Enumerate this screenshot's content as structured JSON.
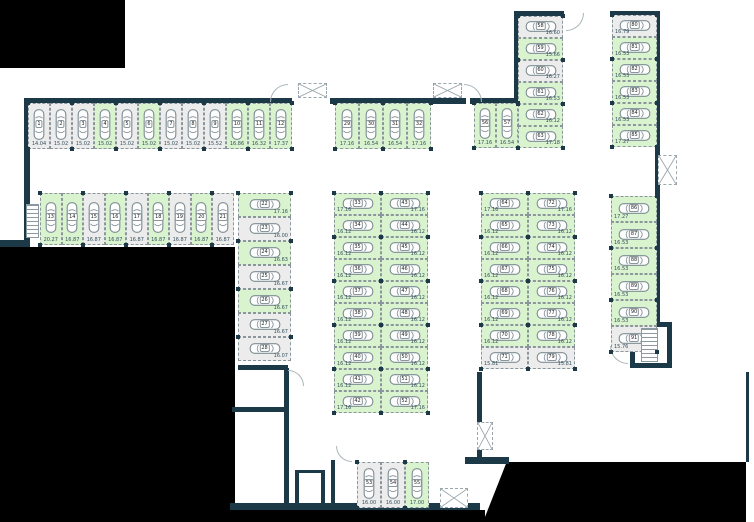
{
  "plan": {
    "name": "underground-parking-level-plan",
    "colors": {
      "wall": "#1c3947",
      "available_fill": "#d8f3cd",
      "occupied_fill": "#ececec",
      "void": "#000000"
    },
    "groups": [
      {
        "name": "north-row-west",
        "stack": "h",
        "x": 28,
        "y": 103,
        "w": 22,
        "h": 46,
        "label": "bottom",
        "stalls": [
          {
            "n": "1",
            "size": "14.04",
            "state": "occupied"
          },
          {
            "n": "2",
            "size": "15.02",
            "state": "occupied"
          },
          {
            "n": "3",
            "size": "15.02",
            "state": "occupied"
          },
          {
            "n": "4",
            "size": "15.02",
            "state": "available"
          },
          {
            "n": "5",
            "size": "15.02",
            "state": "occupied"
          },
          {
            "n": "6",
            "size": "15.02",
            "state": "available"
          },
          {
            "n": "7",
            "size": "15.02",
            "state": "occupied"
          },
          {
            "n": "8",
            "size": "15.02",
            "state": "occupied"
          },
          {
            "n": "9",
            "size": "15.52",
            "state": "occupied"
          },
          {
            "n": "10",
            "size": "16.86",
            "state": "available"
          },
          {
            "n": "11",
            "size": "16.32",
            "state": "available"
          },
          {
            "n": "12",
            "size": "17.37",
            "state": "available"
          }
        ]
      },
      {
        "name": "north-row-mid",
        "stack": "h",
        "x": 335,
        "y": 103,
        "w": 24,
        "h": 46,
        "label": "bottom",
        "stalls": [
          {
            "n": "29",
            "size": "17.16",
            "state": "available"
          },
          {
            "n": "30",
            "size": "16.54",
            "state": "available"
          },
          {
            "n": "31",
            "size": "16.54",
            "state": "available"
          },
          {
            "n": "32",
            "size": "17.16",
            "state": "available"
          }
        ]
      },
      {
        "name": "north-row-east",
        "stack": "h",
        "x": 474,
        "y": 103,
        "w": 22,
        "h": 45,
        "label": "bottom",
        "stalls": [
          {
            "n": "56",
            "size": "17.16",
            "state": "available"
          },
          {
            "n": "57",
            "size": "16.54",
            "state": "available"
          }
        ]
      },
      {
        "name": "northeast-col-west",
        "stack": "v",
        "x": 518,
        "y": 16,
        "w": 45,
        "h": 22,
        "label": "right",
        "stalls": [
          {
            "n": "58",
            "size": "16.60",
            "state": "occupied"
          },
          {
            "n": "59",
            "size": "15.66",
            "state": "available"
          },
          {
            "n": "60",
            "size": "16.27",
            "state": "occupied"
          },
          {
            "n": "61",
            "size": "16.53",
            "state": "available"
          },
          {
            "n": "62",
            "size": "16.12",
            "state": "available"
          },
          {
            "n": "63",
            "size": "17.18",
            "state": "available"
          }
        ]
      },
      {
        "name": "northeast-col-east",
        "stack": "v",
        "x": 612,
        "y": 15,
        "w": 45,
        "h": 22,
        "label": "left",
        "stalls": [
          {
            "n": "80",
            "size": "16.79",
            "state": "occupied"
          },
          {
            "n": "81",
            "size": "16.53",
            "state": "available"
          },
          {
            "n": "82",
            "size": "16.53",
            "state": "available"
          },
          {
            "n": "83",
            "size": "16.53",
            "state": "available"
          },
          {
            "n": "84",
            "size": "16.53",
            "state": "available"
          },
          {
            "n": "85",
            "size": "17.27",
            "state": "available"
          }
        ]
      },
      {
        "name": "second-row-west",
        "stack": "h",
        "x": 40,
        "y": 193,
        "w": 21.5,
        "h": 52,
        "label": "bottom",
        "stalls": [
          {
            "n": "13",
            "size": "20.27",
            "state": "available"
          },
          {
            "n": "14",
            "size": "16.87",
            "state": "available"
          },
          {
            "n": "15",
            "size": "16.87",
            "state": "occupied"
          },
          {
            "n": "16",
            "size": "16.87",
            "state": "available"
          },
          {
            "n": "17",
            "size": "16.87",
            "state": "occupied"
          },
          {
            "n": "18",
            "size": "16.87",
            "state": "available"
          },
          {
            "n": "19",
            "size": "16.87",
            "state": "occupied"
          },
          {
            "n": "20",
            "size": "16.87",
            "state": "available"
          },
          {
            "n": "21",
            "size": "16.87",
            "state": "occupied"
          }
        ]
      },
      {
        "name": "west-col",
        "stack": "v",
        "x": 238,
        "y": 193,
        "w": 53,
        "h": 24,
        "label": "right",
        "stalls": [
          {
            "n": "22",
            "size": "17.16",
            "state": "available"
          },
          {
            "n": "23",
            "size": "16.00",
            "state": "occupied"
          },
          {
            "n": "24",
            "size": "16.63",
            "state": "available"
          },
          {
            "n": "25",
            "size": "16.67",
            "state": "occupied"
          },
          {
            "n": "26",
            "size": "16.67",
            "state": "available"
          },
          {
            "n": "27",
            "size": "16.67",
            "state": "occupied"
          },
          {
            "n": "28",
            "size": "16.07",
            "state": "occupied"
          }
        ]
      },
      {
        "name": "center-col-west",
        "stack": "v",
        "x": 334,
        "y": 193,
        "w": 47,
        "h": 22,
        "label": "left",
        "stalls": [
          {
            "n": "33",
            "size": "17.16",
            "state": "available"
          },
          {
            "n": "34",
            "size": "16.12",
            "state": "available"
          },
          {
            "n": "35",
            "size": "16.12",
            "state": "available"
          },
          {
            "n": "36",
            "size": "16.12",
            "state": "available"
          },
          {
            "n": "37",
            "size": "16.12",
            "state": "available"
          },
          {
            "n": "38",
            "size": "16.12",
            "state": "available"
          },
          {
            "n": "39",
            "size": "16.12",
            "state": "available"
          },
          {
            "n": "40",
            "size": "16.12",
            "state": "available"
          },
          {
            "n": "41",
            "size": "16.12",
            "state": "available"
          },
          {
            "n": "42",
            "size": "17.16",
            "state": "available"
          }
        ]
      },
      {
        "name": "center-col-east",
        "stack": "v",
        "x": 381,
        "y": 193,
        "w": 47,
        "h": 22,
        "label": "right",
        "stalls": [
          {
            "n": "43",
            "size": "17.16",
            "state": "available"
          },
          {
            "n": "44",
            "size": "16.12",
            "state": "available"
          },
          {
            "n": "45",
            "size": "16.12",
            "state": "available"
          },
          {
            "n": "46",
            "size": "16.12",
            "state": "available"
          },
          {
            "n": "47",
            "size": "16.12",
            "state": "available"
          },
          {
            "n": "48",
            "size": "16.12",
            "state": "available"
          },
          {
            "n": "49",
            "size": "16.12",
            "state": "available"
          },
          {
            "n": "50",
            "size": "16.12",
            "state": "available"
          },
          {
            "n": "51",
            "size": "16.12",
            "state": "available"
          },
          {
            "n": "52",
            "size": "17.16",
            "state": "available"
          }
        ]
      },
      {
        "name": "east-col-west",
        "stack": "v",
        "x": 481,
        "y": 193,
        "w": 47,
        "h": 22,
        "label": "left",
        "stalls": [
          {
            "n": "64",
            "size": "17.16",
            "state": "available"
          },
          {
            "n": "65",
            "size": "16.12",
            "state": "available"
          },
          {
            "n": "66",
            "size": "16.12",
            "state": "available"
          },
          {
            "n": "67",
            "size": "16.12",
            "state": "available"
          },
          {
            "n": "68",
            "size": "16.12",
            "state": "available"
          },
          {
            "n": "69",
            "size": "16.12",
            "state": "available"
          },
          {
            "n": "70",
            "size": "16.12",
            "state": "available"
          },
          {
            "n": "71",
            "size": "15.81",
            "state": "occupied"
          }
        ]
      },
      {
        "name": "east-col-east",
        "stack": "v",
        "x": 528,
        "y": 193,
        "w": 47,
        "h": 22,
        "label": "right",
        "stalls": [
          {
            "n": "72",
            "size": "17.16",
            "state": "available"
          },
          {
            "n": "73",
            "size": "16.12",
            "state": "available"
          },
          {
            "n": "74",
            "size": "16.12",
            "state": "available"
          },
          {
            "n": "75",
            "size": "16.12",
            "state": "available"
          },
          {
            "n": "76",
            "size": "16.12",
            "state": "available"
          },
          {
            "n": "77",
            "size": "16.12",
            "state": "available"
          },
          {
            "n": "78",
            "size": "16.12",
            "state": "available"
          },
          {
            "n": "79",
            "size": "15.81",
            "state": "occupied"
          }
        ]
      },
      {
        "name": "far-east-col",
        "stack": "v",
        "x": 611,
        "y": 196,
        "w": 46,
        "h": 26,
        "label": "left",
        "stalls": [
          {
            "n": "86",
            "size": "17.27",
            "state": "available"
          },
          {
            "n": "87",
            "size": "16.53",
            "state": "available"
          },
          {
            "n": "88",
            "size": "16.53",
            "state": "available"
          },
          {
            "n": "89",
            "size": "16.53",
            "state": "available"
          },
          {
            "n": "90",
            "size": "16.53",
            "state": "available"
          },
          {
            "n": "91",
            "size": "15.76",
            "state": "occupied"
          }
        ]
      },
      {
        "name": "south-row",
        "stack": "h",
        "x": 357,
        "y": 462,
        "w": 24,
        "h": 46,
        "label": "bottom",
        "stalls": [
          {
            "n": "53",
            "size": "16.00",
            "state": "occupied"
          },
          {
            "n": "54",
            "size": "16.00",
            "state": "occupied"
          },
          {
            "n": "55",
            "size": "17.00",
            "state": "available"
          }
        ]
      }
    ]
  }
}
